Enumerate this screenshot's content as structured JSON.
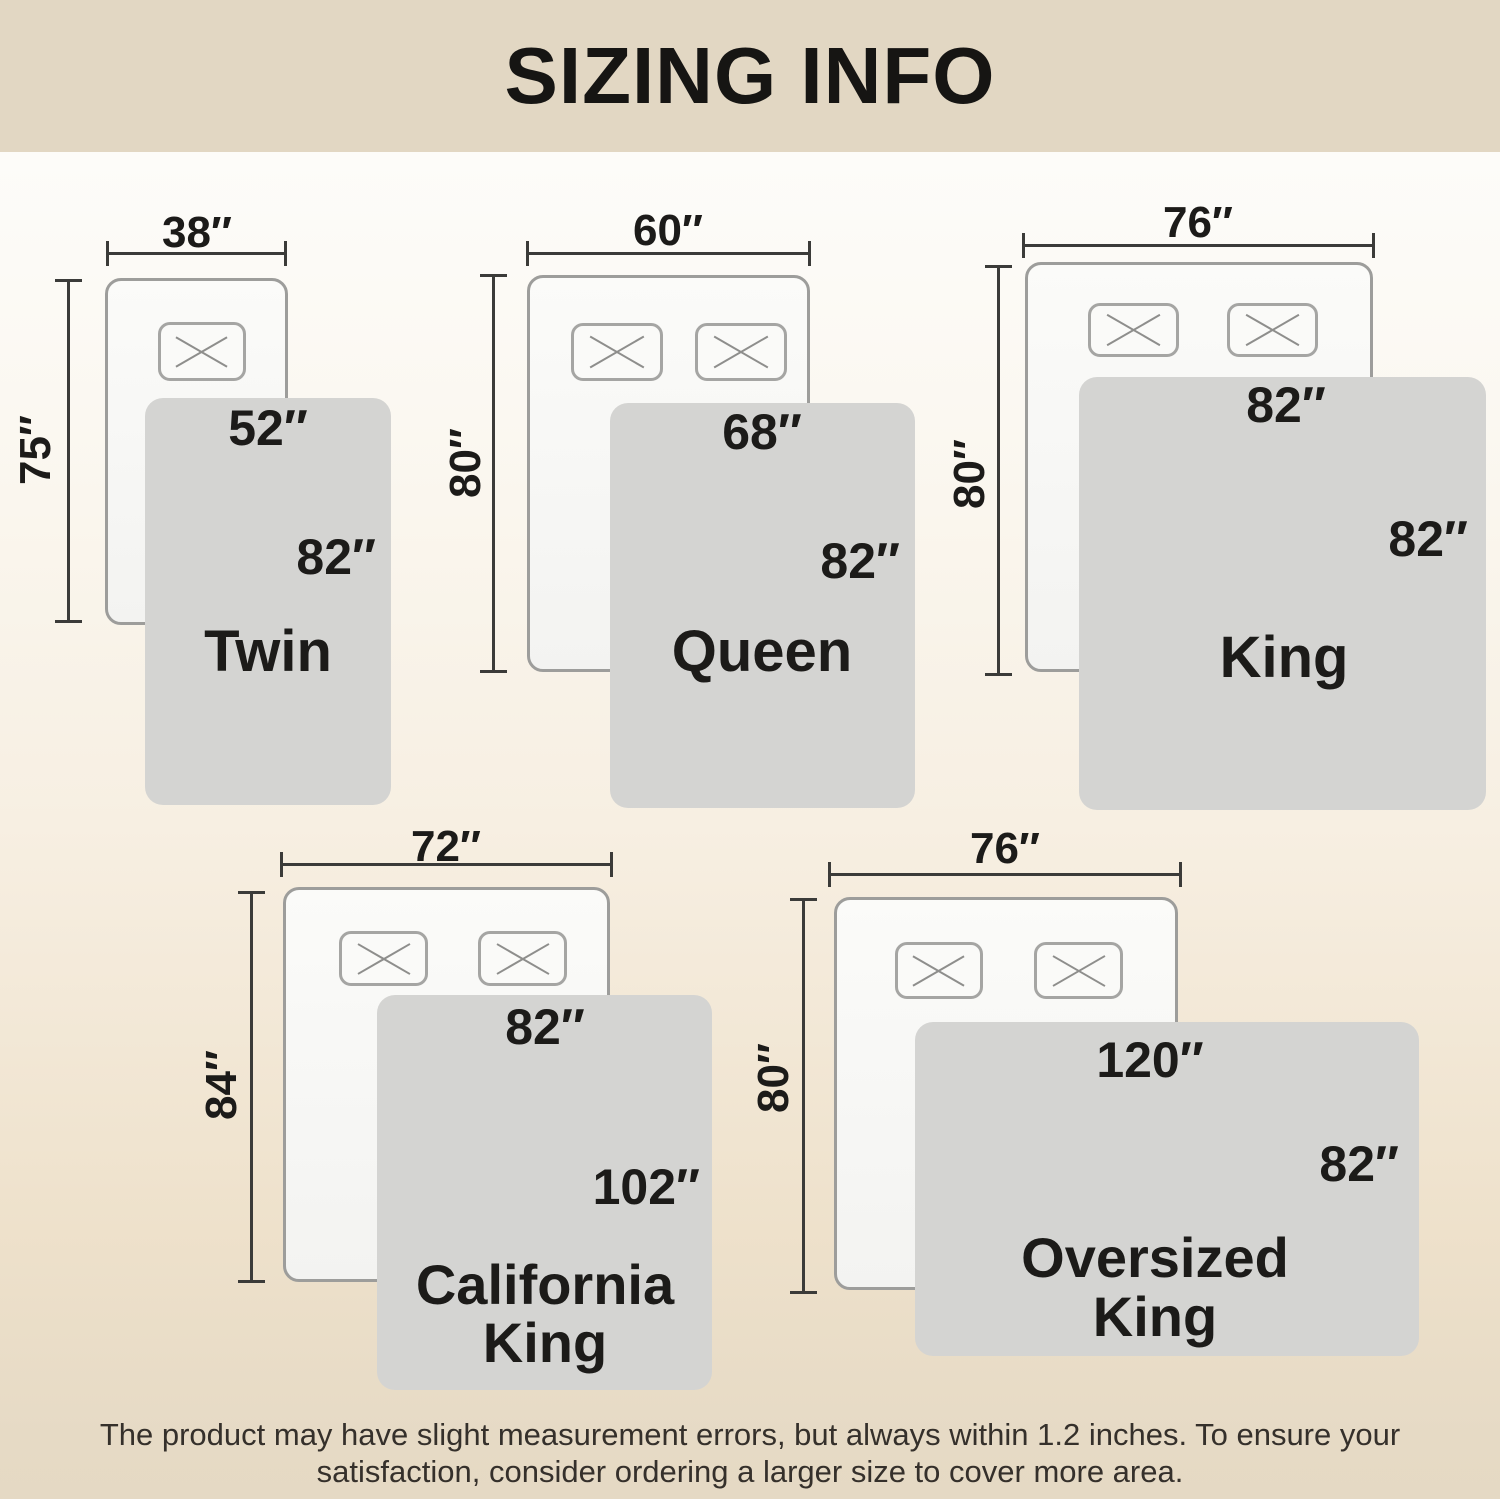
{
  "header": {
    "title": "SIZING INFO"
  },
  "colors": {
    "header_bg": "#e2d7c3",
    "page_top": "#fefefe",
    "page_bottom": "#e5d9c4",
    "blanket": "#d4d4d2",
    "bed_border": "#9d9d9b",
    "dimension_line": "#3b3b39",
    "text": "#1c1b19"
  },
  "diagrams": [
    {
      "name": "Twin",
      "name_lines": [
        "Twin"
      ],
      "bed_width": "38″",
      "bed_length": "75″",
      "blanket_width": "52″",
      "blanket_length": "82″"
    },
    {
      "name": "Queen",
      "name_lines": [
        "Queen"
      ],
      "bed_width": "60″",
      "bed_length": "80″",
      "blanket_width": "68″",
      "blanket_length": "82″"
    },
    {
      "name": "King",
      "name_lines": [
        "King"
      ],
      "bed_width": "76″",
      "bed_length": "80″",
      "blanket_width": "82″",
      "blanket_length": "82″"
    },
    {
      "name": "California King",
      "name_lines": [
        "California",
        "King"
      ],
      "bed_width": "72″",
      "bed_length": "84″",
      "blanket_width": "82″",
      "blanket_length": "102″"
    },
    {
      "name": "Oversized King",
      "name_lines": [
        "Oversized",
        "King"
      ],
      "bed_width": "76″",
      "bed_length": "80″",
      "blanket_width": "120″",
      "blanket_length": "82″"
    }
  ],
  "disclaimer": {
    "line1": "The product may have slight measurement errors, but always within 1.2 inches. To ensure your",
    "line2": "satisfaction, consider ordering a larger size to cover more area."
  }
}
